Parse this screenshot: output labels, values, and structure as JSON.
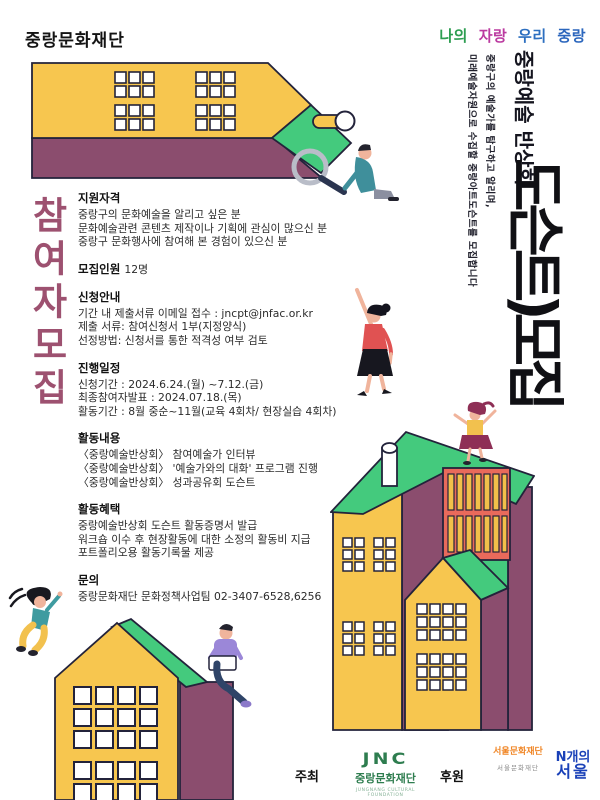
{
  "brand": {
    "name": "중랑문화재단"
  },
  "slogan": {
    "words": [
      {
        "text": "나의",
        "color": "#2e9e52"
      },
      {
        "text": "자랑",
        "color": "#bb3aa0"
      },
      {
        "text": "우리",
        "color": "#2d6fc0"
      },
      {
        "text": "중랑",
        "color": "#2b66bd"
      }
    ]
  },
  "left_title": "참여자모집",
  "right": {
    "subtitle": "중랑예술 반상회",
    "tagline1": "중랑구의 예술가를 탐구하고 알리며,",
    "tagline2": "미래예술자원으로 수집할 중랑아트도슨트를 모집합니다",
    "main_title": "도슨트)모집"
  },
  "sections": [
    {
      "heading": "지원자격",
      "lines": [
        "중랑구의 문화예술을 알리고 싶은 분",
        "문화예술관련 콘텐츠 제작이나 기획에 관심이 많으신 분",
        "중랑구 문화행사에 참여해 본 경험이 있으신 분"
      ]
    },
    {
      "heading": "모집인원",
      "inline": "12명",
      "lines": []
    },
    {
      "heading": "신청안내",
      "lines": [
        "기간 내 제출서류 이메일 접수 : jncpt@jnfac.or.kr",
        "제출 서류: 참여신청서 1부(지정양식)",
        "선정방법: 신청서를 통한 적격성 여부 검토"
      ]
    },
    {
      "heading": "진행일정",
      "lines": [
        "신청기간 : 2024.6.24.(월) ~7.12.(금)",
        "최종참여자발표 : 2024.07.18.(목)",
        "활동기간 : 8월 중순~11월(교육 4회차/ 현장실습 4회차)"
      ]
    },
    {
      "heading": "활동내용",
      "lines": [
        "〈중랑예술반상회〉 참여예술가 인터뷰",
        "〈중랑예술반상회〉 '예술가와의 대화' 프로그램 진행",
        "〈중랑예술반상회〉 성과공유회 도슨트"
      ]
    },
    {
      "heading": "활동혜택",
      "lines": [
        "중랑예술반상회 도슨트 활동증명서 발급",
        "워크숍 이수 후 현장활동에 대한 소정의 활동비 지급",
        "포트폴리오용  활동기록물 제공"
      ]
    },
    {
      "heading": "문의",
      "lines": [
        "중랑문화재단 문화정책사업팀 02-3407-6528,6256"
      ]
    }
  ],
  "footer": {
    "host_label": "주최",
    "host_logo": {
      "mark": "JNC",
      "name": "중랑문화재단",
      "caption": "JUNGNANG CULTURAL FOUNDATION"
    },
    "sponsor_label": "후원",
    "sponsor_logo": {
      "mark": "서울문화재단",
      "caption": "서울문화재단"
    },
    "partner_logo": {
      "line1": "N개의",
      "line2": "서울"
    }
  },
  "colors": {
    "house_yellow": "#f7c64f",
    "house_green": "#44ca7d",
    "house_purple": "#8b4d6e",
    "outline": "#23233b",
    "panel_orange": "#e96a5b",
    "slat_yellow": "#f2c04a",
    "left_title_rose": "#9d5170",
    "jnc_green": "#2e7d4f",
    "sfac_orange": "#f08626",
    "nseoul_blue": "#1a41b8"
  }
}
